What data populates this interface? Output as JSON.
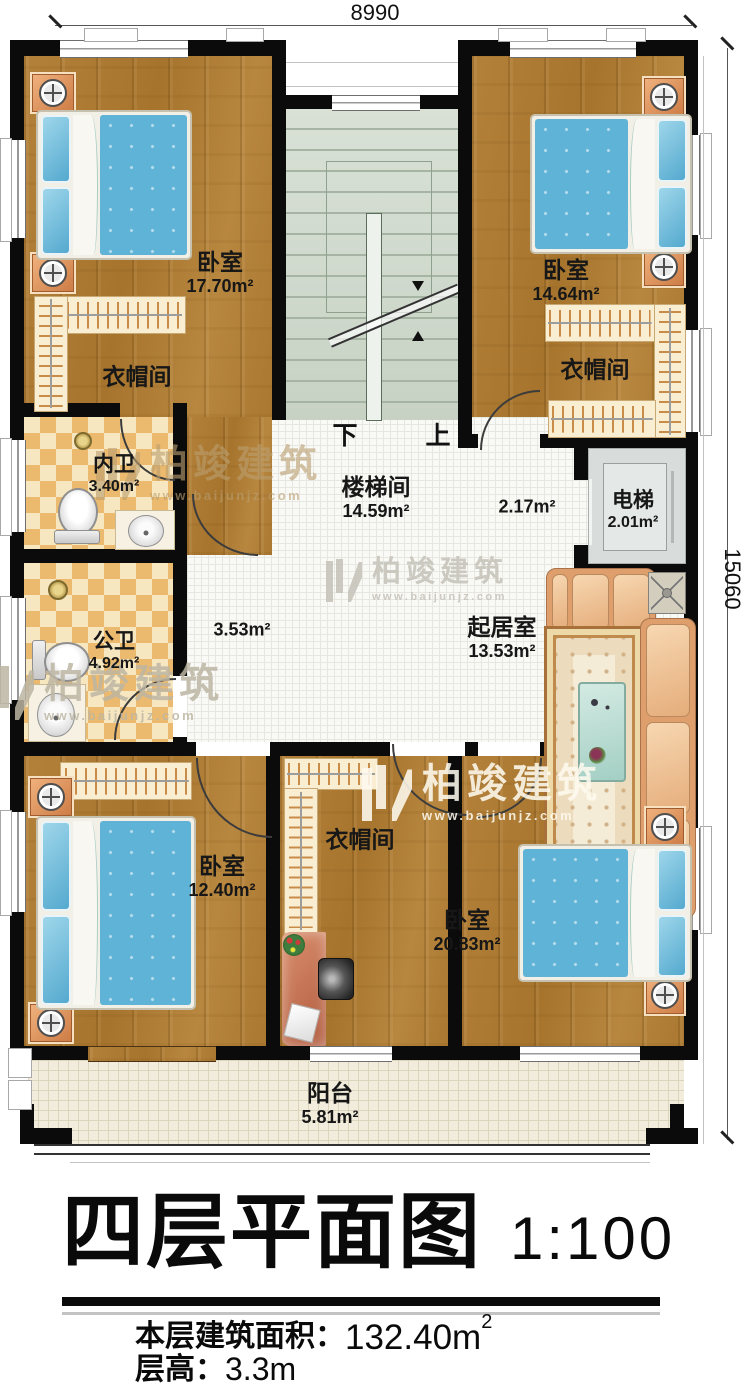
{
  "dimensions": {
    "width": "8990",
    "height": "15060"
  },
  "watermark": {
    "brand": "柏竣建筑",
    "url": "www.baijunjz.com"
  },
  "stairs": {
    "down": "下",
    "up": "上"
  },
  "rooms": {
    "bedroom_tl": {
      "name": "卧室",
      "area": "17.70m²"
    },
    "bedroom_tr": {
      "name": "卧室",
      "area": "14.64m²"
    },
    "closet_tl": {
      "name": "衣帽间"
    },
    "closet_tr": {
      "name": "衣帽间"
    },
    "closet_bottom": {
      "name": "衣帽间"
    },
    "bath_inner": {
      "name": "内卫",
      "area": "3.40m²"
    },
    "bath_public": {
      "name": "公卫",
      "area": "4.92m²"
    },
    "stairwell": {
      "name": "楼梯间",
      "area": "14.59m²"
    },
    "elevator": {
      "name": "电梯",
      "area": "2.01m²"
    },
    "living": {
      "name": "起居室",
      "area": "13.53m²"
    },
    "landing": {
      "area": "2.17m²"
    },
    "hallway": {
      "area": "3.53m²"
    },
    "bedroom_bl": {
      "name": "卧室",
      "area": "12.40m²"
    },
    "bedroom_br": {
      "name": "卧室",
      "area": "20.83m²"
    },
    "balcony": {
      "name": "阳台",
      "area": "5.81m²"
    }
  },
  "title": {
    "main": "四层平面图",
    "scale": "1:100"
  },
  "info": {
    "area_label": "本层建筑面积：",
    "area_value": "132.40m",
    "area_sup": "2",
    "height_label": "层高：",
    "height_value": "3.3m"
  }
}
